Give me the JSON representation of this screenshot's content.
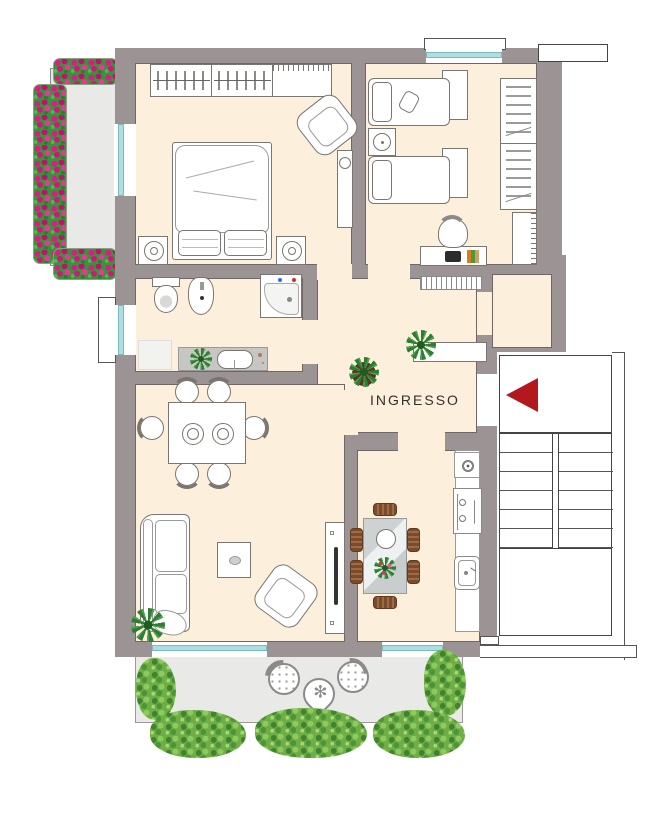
{
  "labels": {
    "entrance": "INGRESSO"
  },
  "entrance_arrow": {
    "direction": "left",
    "color": "#b2181d"
  },
  "colors": {
    "wall": "#9b9394",
    "room_floor": "#fcefdb",
    "outdoor_floor": "#e9e9e7",
    "window_glass": "#aadfe3",
    "entrance_arrow": "#b2181d",
    "flowers": "#d61f84",
    "foliage": "#3e8f3e",
    "bush": "#6fae46",
    "wood_chair": "#7a4b2c"
  },
  "rooms": [
    {
      "id": "bedroom-main",
      "furniture": [
        "wardrobe-with-hangers",
        "shelf-section",
        "double-bed",
        "pillows",
        "nightstand-left",
        "nightstand-right",
        "table-lamps",
        "armchair",
        "dresser-with-fan"
      ]
    },
    {
      "id": "bedroom-second",
      "furniture": [
        "single-bed-top",
        "single-bed-bottom",
        "nightstand-top",
        "nightstand-bottom",
        "round-side-table",
        "wardrobe-side-view",
        "shelf-unit",
        "desk",
        "desk-chair",
        "laptop",
        "books"
      ]
    },
    {
      "id": "bathroom",
      "furniture": [
        "toilet",
        "bidet",
        "corner-shower",
        "washing-machine",
        "vanity-counter",
        "sink",
        "plant"
      ]
    },
    {
      "id": "entrance-hall",
      "furniture": [
        "console-table",
        "potted-plant-on-console",
        "potted-plant-floor",
        "radiator"
      ]
    },
    {
      "id": "closet-room",
      "furniture": []
    },
    {
      "id": "living-room",
      "furniture": [
        "dining-table",
        "plates",
        "dining-chairs",
        "sofa",
        "coffee-table",
        "armchair",
        "tv-cabinet",
        "tv",
        "corner-plant"
      ]
    },
    {
      "id": "kitchen",
      "furniture": [
        "glass-table",
        "wooden-chairs",
        "plate",
        "plant-bowl",
        "counter",
        "cooktop",
        "double-sink",
        "basin"
      ]
    },
    {
      "id": "stairwell",
      "furniture": [
        "upper-landing",
        "entrance-arrow",
        "stair-flight-left",
        "stair-flight-right",
        "lower-landing"
      ]
    },
    {
      "id": "balcony-left",
      "furniture": [
        "flower-box-top",
        "flower-box-side",
        "flower-box-bottom"
      ]
    },
    {
      "id": "terrace-bottom",
      "furniture": [
        "wicker-chair-left",
        "wicker-chair-right",
        "teardrop-table",
        "star-plant",
        "bushes"
      ]
    }
  ]
}
